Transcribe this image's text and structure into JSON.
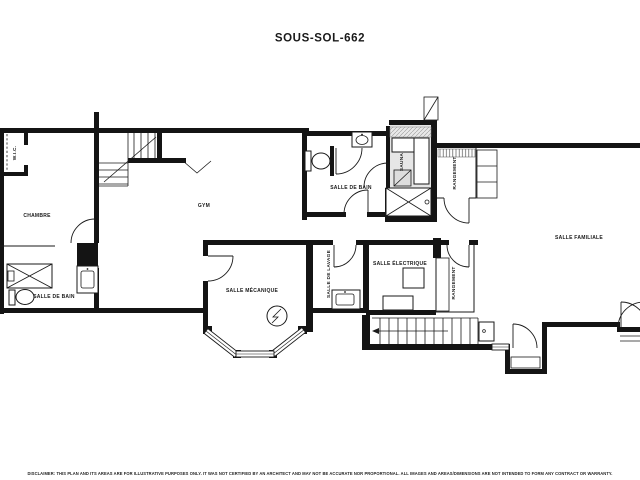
{
  "title": "SOUS-SOL-662",
  "rooms": {
    "wic": "W.I.C.",
    "chambre": "CHAMBRE",
    "gym": "GYM",
    "bathroom_upper": "SALLE DE BAIN",
    "sauna": "SAUNA",
    "storage_upper": "RANGEMENT",
    "family_room": "SALLE FAMILIALE",
    "mechanical_room": "SALLE MÉCANIQUE",
    "laundry_room": "SALLE DE LAVAGE",
    "electrical_room": "SALLE ÉLECTRIQUE",
    "storage_lower": "RANGEMENT",
    "bathroom_lower": "SALLE DE BAIN"
  },
  "footer": {
    "disclaimer": "DISCLAIMER: THIS PLAN AND ITS AREAS ARE FOR ILLUSTRATIVE PURPOSES ONLY. IT WAS NOT CERTIFIED BY AN ARCHITECT AND MAY NOT BE ACCURATE NOR PROPORTIONAL. ALL IMAGES AND AREAS/DIMENSIONS ARE NOT INTENDED TO FORM ANY CONTRACT OR WARRANTY."
  },
  "colors": {
    "wall": "#141414",
    "line": "#1a1a1a",
    "sauna_fill": "#e6e6e6",
    "background": "#ffffff"
  }
}
